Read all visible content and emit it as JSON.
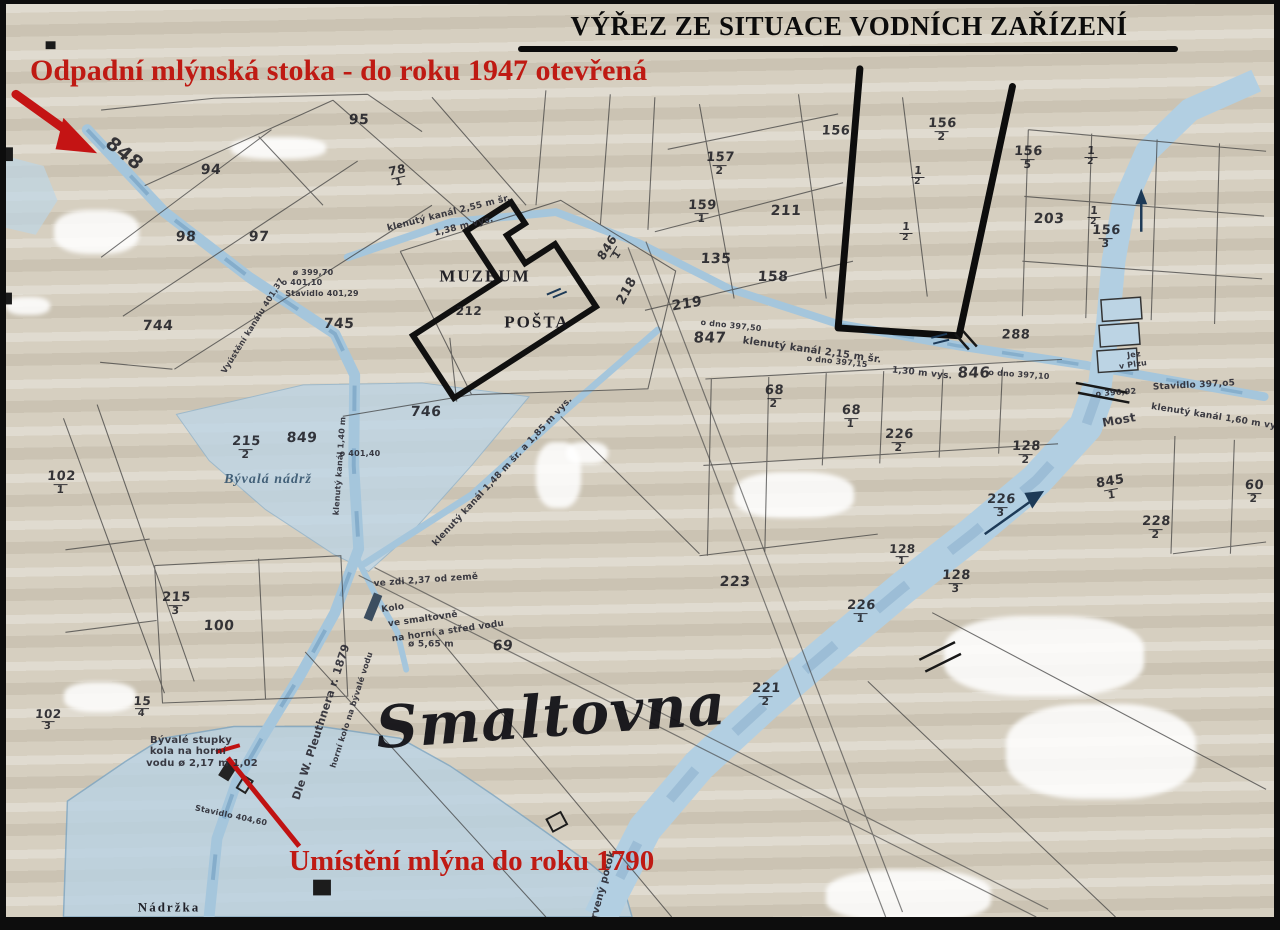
{
  "title": "VÝŘEZ ZE SITUACE VODNÍCH ZAŘÍZENÍ",
  "annotations": {
    "top_red": "Odpadní mlýnská stoka - do roku 1947 otevřená",
    "bottom_red": "Umístění mlýna do roku 1790"
  },
  "colors": {
    "paper": "#d6cfc0",
    "water_fill": "#adcbdf",
    "water_deep": "#7fa9c9",
    "annotation_red": "#bf1a13",
    "ink": "#222222",
    "marker_black": "#0d0d0d"
  },
  "map_labels": [
    {
      "text": "848",
      "x": 118,
      "y": 150,
      "rot": 38,
      "size": 19,
      "kind": "hand"
    },
    {
      "text": "94",
      "x": 205,
      "y": 166,
      "kind": "hand"
    },
    {
      "text": "95",
      "x": 353,
      "y": 116,
      "kind": "hand"
    },
    {
      "text": "78/1",
      "x": 392,
      "y": 172,
      "rot": -12,
      "kind": "hand",
      "size": 12
    },
    {
      "text": "98",
      "x": 180,
      "y": 233,
      "kind": "hand"
    },
    {
      "text": "97",
      "x": 253,
      "y": 233,
      "kind": "hand"
    },
    {
      "text": "744",
      "x": 152,
      "y": 322,
      "kind": "hand"
    },
    {
      "text": "745",
      "x": 333,
      "y": 320,
      "kind": "hand"
    },
    {
      "text": "746",
      "x": 420,
      "y": 408,
      "kind": "hand"
    },
    {
      "text": "849",
      "x": 296,
      "y": 434,
      "kind": "hand"
    },
    {
      "text": "215/2",
      "x": 240,
      "y": 444,
      "kind": "hand",
      "size": 13
    },
    {
      "text": "102/1",
      "x": 55,
      "y": 479,
      "kind": "hand",
      "size": 13
    },
    {
      "text": "215/3",
      "x": 170,
      "y": 600,
      "kind": "hand",
      "size": 13
    },
    {
      "text": "100",
      "x": 213,
      "y": 622,
      "kind": "hand"
    },
    {
      "text": "15/4",
      "x": 136,
      "y": 703,
      "kind": "hand",
      "size": 12
    },
    {
      "text": "102/3",
      "x": 42,
      "y": 716,
      "kind": "hand",
      "size": 12
    },
    {
      "text": "69",
      "x": 497,
      "y": 642,
      "kind": "hand"
    },
    {
      "text": "223",
      "x": 729,
      "y": 578,
      "kind": "hand"
    },
    {
      "text": "221/2",
      "x": 760,
      "y": 691,
      "kind": "hand",
      "size": 13
    },
    {
      "text": "226/1",
      "x": 855,
      "y": 608,
      "kind": "hand",
      "size": 13
    },
    {
      "text": "226/3",
      "x": 995,
      "y": 502,
      "kind": "hand",
      "size": 13
    },
    {
      "text": "226/2",
      "x": 893,
      "y": 437,
      "kind": "hand",
      "size": 13
    },
    {
      "text": "128/2",
      "x": 1020,
      "y": 449,
      "kind": "hand",
      "size": 13
    },
    {
      "text": "128/3",
      "x": 950,
      "y": 578,
      "kind": "hand",
      "size": 13
    },
    {
      "text": "128/1",
      "x": 896,
      "y": 551,
      "kind": "hand",
      "size": 12
    },
    {
      "text": "228/2",
      "x": 1150,
      "y": 524,
      "kind": "hand",
      "size": 13
    },
    {
      "text": "68/2",
      "x": 768,
      "y": 393,
      "kind": "hand",
      "size": 13
    },
    {
      "text": "68/1",
      "x": 845,
      "y": 413,
      "kind": "hand",
      "size": 13
    },
    {
      "text": "60/2",
      "x": 1248,
      "y": 488,
      "kind": "hand",
      "size": 13
    },
    {
      "text": "157/2",
      "x": 714,
      "y": 160,
      "kind": "hand",
      "size": 13
    },
    {
      "text": "159/1",
      "x": 696,
      "y": 208,
      "kind": "hand",
      "size": 13
    },
    {
      "text": "211",
      "x": 780,
      "y": 207,
      "kind": "hand"
    },
    {
      "text": "135",
      "x": 710,
      "y": 255,
      "kind": "hand"
    },
    {
      "text": "158",
      "x": 767,
      "y": 273,
      "kind": "hand"
    },
    {
      "text": "156",
      "x": 830,
      "y": 127,
      "kind": "hand",
      "size": 13
    },
    {
      "text": "156/2",
      "x": 936,
      "y": 126,
      "kind": "hand",
      "size": 13
    },
    {
      "text": "156/5",
      "x": 1022,
      "y": 154,
      "kind": "hand",
      "size": 13
    },
    {
      "text": "203",
      "x": 1043,
      "y": 215,
      "kind": "hand"
    },
    {
      "text": "156/3",
      "x": 1100,
      "y": 233,
      "kind": "hand",
      "size": 13
    },
    {
      "text": "288",
      "x": 1010,
      "y": 331,
      "kind": "hand",
      "size": 13
    },
    {
      "text": "845/1",
      "x": 1105,
      "y": 484,
      "rot": -10,
      "kind": "hand",
      "size": 13
    },
    {
      "text": "218",
      "x": 621,
      "y": 287,
      "rot": -62,
      "kind": "hand",
      "size": 13
    },
    {
      "text": "846/1",
      "x": 606,
      "y": 247,
      "rot": -58,
      "kind": "hand",
      "size": 12
    },
    {
      "text": "219",
      "x": 681,
      "y": 300,
      "rot": -10,
      "kind": "hand"
    },
    {
      "text": "847",
      "x": 704,
      "y": 334,
      "size": 15,
      "kind": "hand"
    },
    {
      "text": "846",
      "x": 968,
      "y": 369,
      "size": 15,
      "kind": "hand"
    },
    {
      "text": "212",
      "x": 463,
      "y": 307,
      "size": 12,
      "kind": "hand"
    },
    {
      "text": "1/2",
      "x": 912,
      "y": 172,
      "size": 11,
      "kind": "hand"
    },
    {
      "text": "1/2",
      "x": 900,
      "y": 228,
      "size": 11,
      "kind": "hand"
    },
    {
      "text": "1/2",
      "x": 1085,
      "y": 152,
      "size": 11,
      "kind": "hand"
    },
    {
      "text": "1/2",
      "x": 1088,
      "y": 212,
      "size": 11,
      "kind": "hand"
    },
    {
      "text": "klenutý kanál 2,55 m šr.",
      "x": 443,
      "y": 210,
      "rot": -14,
      "size": 9,
      "kind": "note"
    },
    {
      "text": "1,38 m vys.",
      "x": 458,
      "y": 223,
      "rot": -14,
      "size": 9,
      "kind": "note"
    },
    {
      "text": "klenutý kanál 2,15 m šr.",
      "x": 806,
      "y": 347,
      "rot": 8,
      "size": 10,
      "kind": "note"
    },
    {
      "text": "1,30 m vys.",
      "x": 916,
      "y": 370,
      "rot": 6,
      "size": 9,
      "kind": "note"
    },
    {
      "text": "o dno 397,50",
      "x": 725,
      "y": 322,
      "rot": 6,
      "size": 8,
      "kind": "note"
    },
    {
      "text": "o dno 397,15",
      "x": 831,
      "y": 358,
      "rot": 6,
      "size": 8,
      "kind": "note"
    },
    {
      "text": "o dno 397,10",
      "x": 1013,
      "y": 371,
      "rot": 4,
      "size": 8,
      "kind": "note"
    },
    {
      "text": "o 396,92",
      "x": 1110,
      "y": 389,
      "rot": -4,
      "size": 8,
      "kind": "note"
    },
    {
      "text": "Stavidlo 397,o5",
      "x": 1188,
      "y": 382,
      "rot": -3,
      "size": 9,
      "kind": "note"
    },
    {
      "text": "klenutý kanál 1,60 m vys.",
      "x": 1212,
      "y": 414,
      "rot": 9,
      "size": 9,
      "kind": "note"
    },
    {
      "text": "Jez",
      "x": 1128,
      "y": 351,
      "rot": -8,
      "size": 8,
      "kind": "note"
    },
    {
      "text": "v Plzu",
      "x": 1127,
      "y": 361,
      "rot": -8,
      "size": 8,
      "kind": "note"
    },
    {
      "text": "ø 399,70",
      "x": 307,
      "y": 269,
      "size": 8,
      "kind": "note"
    },
    {
      "text": "o 401,10",
      "x": 296,
      "y": 279,
      "size": 8,
      "kind": "note"
    },
    {
      "text": "Stavidlo 401,29",
      "x": 316,
      "y": 290,
      "size": 8,
      "kind": "note"
    },
    {
      "text": "Vyústění kanálu 401,37",
      "x": 247,
      "y": 322,
      "rot": -58,
      "size": 8,
      "kind": "note"
    },
    {
      "text": "klenutý kanál 1,48 m šr. a 1,85 m vys.",
      "x": 497,
      "y": 468,
      "rot": -47,
      "size": 9,
      "kind": "note"
    },
    {
      "text": "klenutý kanál 1,40 m",
      "x": 334,
      "y": 462,
      "rot": -86,
      "size": 8,
      "kind": "note"
    },
    {
      "text": "o 401,40",
      "x": 354,
      "y": 450,
      "size": 8,
      "kind": "note"
    },
    {
      "text": "ve zdi 2,37 od země",
      "x": 420,
      "y": 577,
      "rot": -4,
      "size": 9,
      "kind": "note"
    },
    {
      "text": "Kolo",
      "x": 387,
      "y": 605,
      "rot": -8,
      "size": 9,
      "kind": "note"
    },
    {
      "text": "ve smaltovně",
      "x": 417,
      "y": 616,
      "rot": -8,
      "size": 9,
      "kind": "note"
    },
    {
      "text": "na horní a střed vodu",
      "x": 442,
      "y": 628,
      "rot": -8,
      "size": 9,
      "kind": "note"
    },
    {
      "text": "ø 5,65 m",
      "x": 425,
      "y": 641,
      "size": 9,
      "kind": "note"
    },
    {
      "text": "Dle W. Pleuthnera r. 1879",
      "x": 315,
      "y": 718,
      "rot": -72,
      "size": 11,
      "kind": "note"
    },
    {
      "text": "horní kolo na bývalé vodu",
      "x": 346,
      "y": 706,
      "rot": -72,
      "size": 8,
      "kind": "note"
    },
    {
      "text": "Bývalé stupky",
      "x": 185,
      "y": 737,
      "size": 10,
      "kind": "note"
    },
    {
      "text": "kola na horní",
      "x": 182,
      "y": 748,
      "size": 10,
      "kind": "note"
    },
    {
      "text": "vodu ø 2,17 m  1,02",
      "x": 196,
      "y": 760,
      "size": 10,
      "kind": "note"
    },
    {
      "text": "Stavidlo 404,60",
      "x": 225,
      "y": 812,
      "rot": 12,
      "size": 8,
      "kind": "note"
    },
    {
      "text": "Most",
      "x": 1113,
      "y": 416,
      "rot": -10,
      "size": 12,
      "kind": "note"
    },
    {
      "text": "Červený potok",
      "x": 596,
      "y": 888,
      "rot": -75,
      "size": 10,
      "kind": "note"
    },
    {
      "text": "MUZEUM",
      "x": 479,
      "y": 272,
      "size": 17,
      "kind": "place"
    },
    {
      "text": "POŠTA",
      "x": 531,
      "y": 318,
      "size": 17,
      "kind": "place"
    },
    {
      "text": "Bývalá nádrž",
      "x": 262,
      "y": 476,
      "size": 14,
      "kind": "wname"
    },
    {
      "text": "Nádržka",
      "x": 163,
      "y": 903,
      "size": 13,
      "kind": "place"
    },
    {
      "text": "u smaltovny",
      "x": 168,
      "y": 922,
      "size": 13,
      "kind": "place"
    },
    {
      "text": "Smaltovna",
      "x": 545,
      "y": 712,
      "rot": -4,
      "size": 58,
      "kind": "script"
    }
  ]
}
